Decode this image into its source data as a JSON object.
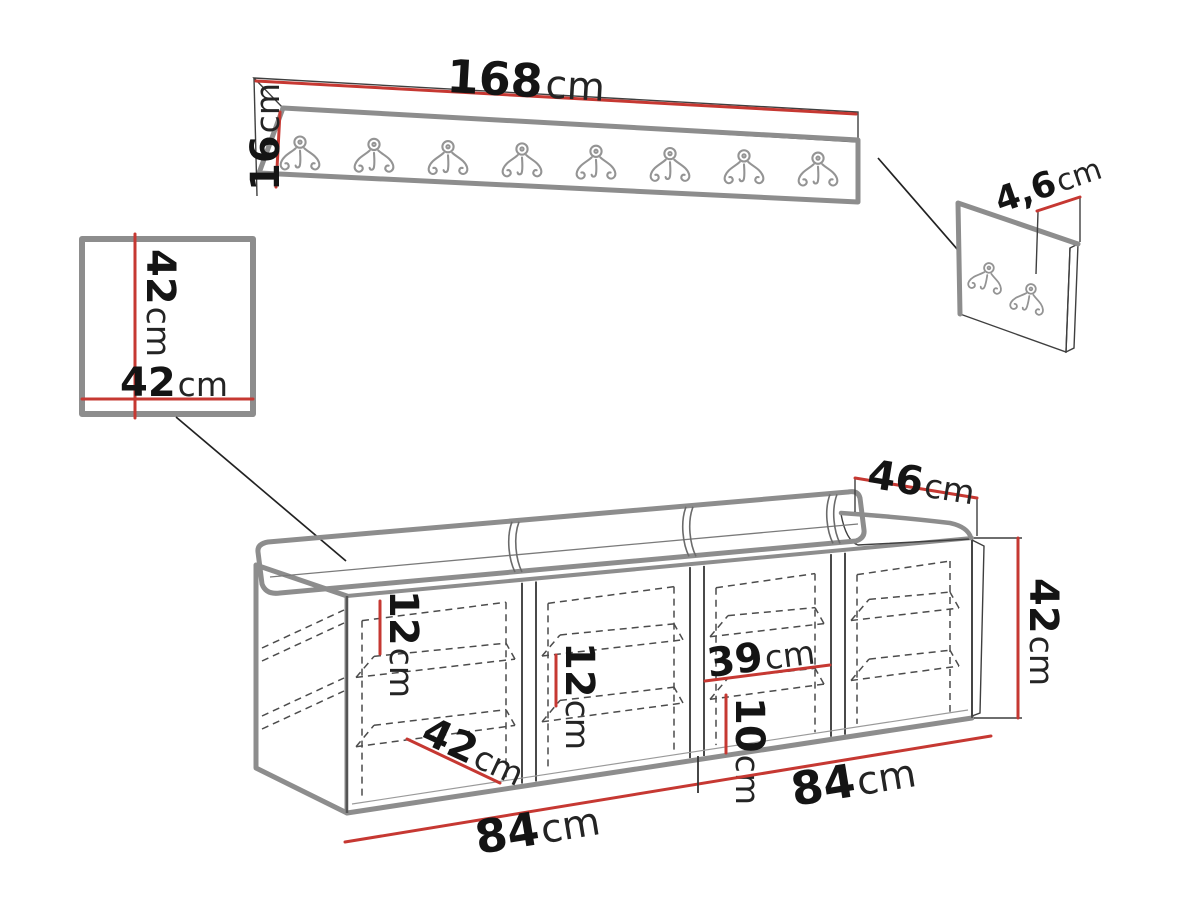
{
  "palette": {
    "accent_red": "#c63832",
    "outline_gray": "#8d8d8d",
    "ink": "#141414",
    "background": "#ffffff"
  },
  "rack": {
    "hook_count": 8,
    "width_label": {
      "num": "168",
      "unit": "cm"
    },
    "height_label": {
      "num": "16",
      "unit": "cm"
    }
  },
  "hook_panel": {
    "hook_count": 2,
    "thickness_label": {
      "num": "4,6",
      "unit": "cm"
    }
  },
  "square_panel": {
    "height_label": {
      "num": "42",
      "unit": "cm"
    },
    "width_label": {
      "num": "42",
      "unit": "cm"
    }
  },
  "bench": {
    "compartment_count": 4,
    "shelves_per_compartment": 2,
    "depth_label": {
      "num": "46",
      "unit": "cm"
    },
    "height_label": {
      "num": "42",
      "unit": "cm"
    },
    "comp1_shelf_label": {
      "num": "12",
      "unit": "cm"
    },
    "comp2_shelf_label": {
      "num": "12",
      "unit": "cm"
    },
    "comp3_width_label": {
      "num": "39",
      "unit": "cm"
    },
    "comp3_shelf_label": {
      "num": "10",
      "unit": "cm"
    },
    "comp1_depth_label": {
      "num": "42",
      "unit": "cm"
    },
    "bottom_left_label": {
      "num": "84",
      "unit": "cm"
    },
    "bottom_right_label": {
      "num": "84",
      "unit": "cm"
    }
  }
}
